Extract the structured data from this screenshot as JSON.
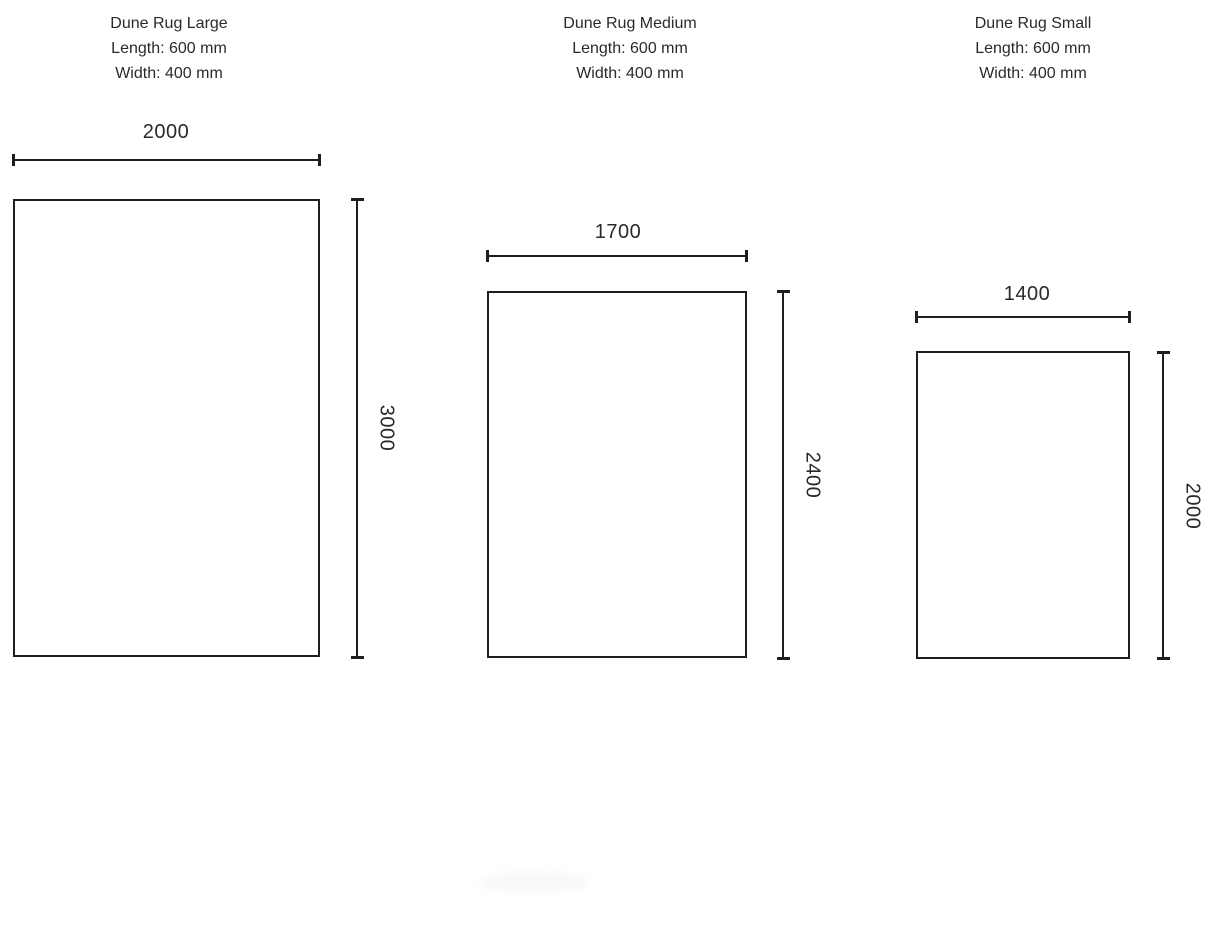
{
  "colors": {
    "line": "#1f1f1f",
    "text": "#2a2a2a",
    "background": "#ffffff"
  },
  "figures": [
    {
      "name": "Dune Rug Large",
      "spec_length": "Length: 600 mm",
      "spec_width": "Width: 400 mm",
      "dim_width": "2000",
      "dim_height": "3000"
    },
    {
      "name": "Dune Rug Medium",
      "spec_length": "Length: 600 mm",
      "spec_width": "Width: 400 mm",
      "dim_width": "1700",
      "dim_height": "2400"
    },
    {
      "name": "Dune Rug Small",
      "spec_length": "Length: 600 mm",
      "spec_width": "Width: 400 mm",
      "dim_width": "1400",
      "dim_height": "2000"
    }
  ]
}
